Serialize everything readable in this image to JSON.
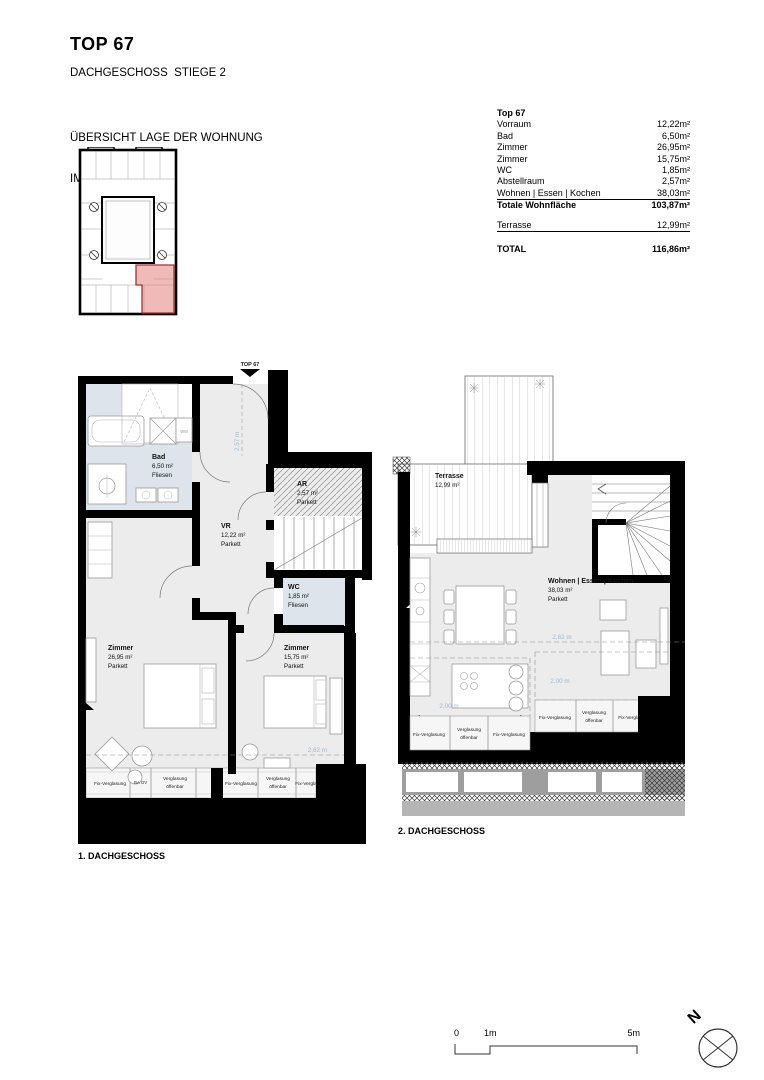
{
  "page": {
    "title": "TOP 67",
    "subtitle": "DACHGESCHOSS  STIEGE 2",
    "overview_heading_1": "ÜBERSICHT LAGE DER WOHNUNG",
    "overview_heading_2": "IM HAUS"
  },
  "area_table": {
    "title": "Top 67",
    "rows": [
      {
        "label": "Vorraum",
        "value": "12,22m²"
      },
      {
        "label": "Bad",
        "value": "6,50m²"
      },
      {
        "label": "Zimmer",
        "value": "26,95m²"
      },
      {
        "label": "Zimmer",
        "value": "15,75m²"
      },
      {
        "label": "WC",
        "value": "1,85m²"
      },
      {
        "label": "Abstellraum",
        "value": "2,57m²"
      },
      {
        "label": "Wohnen | Essen | Kochen",
        "value": "38,03m²"
      }
    ],
    "subtotal_label": "Totale Wohnfläche",
    "subtotal_value": "103,87m²",
    "terrace_label": "Terrasse",
    "terrace_value": "12,99m²",
    "total_label": "TOTAL",
    "total_value": "116,86m²"
  },
  "plan1": {
    "caption": "1. DACHGESCHOSS",
    "entrance_label": "TOP 67",
    "dim_entry": "2,57 m",
    "dim_width": "2,62 m",
    "wm_label": "WM",
    "ba_gv_label": "BA GV",
    "rooms": {
      "bad": {
        "name": "Bad",
        "area": "6,50 m²",
        "floor": "Fliesen"
      },
      "vr": {
        "name": "VR",
        "area": "12,22 m²",
        "floor": "Parkett"
      },
      "ar": {
        "name": "AR",
        "area": "2,57 m²",
        "floor": "Parkett"
      },
      "wc": {
        "name": "WC",
        "area": "1,85 m²",
        "floor": "Fliesen"
      },
      "zimmer_1": {
        "name": "Zimmer",
        "area": "26,95 m²",
        "floor": "Parkett"
      },
      "zimmer_2": {
        "name": "Zimmer",
        "area": "15,75 m²",
        "floor": "Parkett"
      }
    },
    "glazing": [
      {
        "l1": "Fix-Verglasung",
        "l2": ""
      },
      {
        "l1": "Verglasung",
        "l2": "öffenbar"
      },
      {
        "l1": "Fix-Verglasung",
        "l2": ""
      },
      {
        "l1": "Verglasung",
        "l2": "öffenbar"
      },
      {
        "l1": "Fix-Vergla",
        "l2": ""
      }
    ]
  },
  "plan2": {
    "caption": "2. DACHGESCHOSS",
    "dim_width": "2,62 m",
    "dim_left": "2,00 m",
    "dim_right": "2,00 m",
    "rooms": {
      "terrasse": {
        "name": "Terrasse",
        "area": "12,99 m²"
      },
      "wohnen": {
        "name": "Wohnen | Essen | Kochen",
        "area": "38,03 m²",
        "floor": "Parkett"
      }
    },
    "glazing_left": [
      {
        "l1": "Fix-Verglasung",
        "l2": ""
      },
      {
        "l1": "Verglasung",
        "l2": "öffenbar"
      },
      {
        "l1": "Fix-Verglasung",
        "l2": ""
      }
    ],
    "glazing_right": [
      {
        "l1": "Fix-Verglasung",
        "l2": ""
      },
      {
        "l1": "Verglasung",
        "l2": "öffenbar"
      },
      {
        "l1": "Fix-Vergla",
        "l2": ""
      }
    ]
  },
  "scale_bar": {
    "tick0": "0",
    "tick1": "1m",
    "tick5": "5m"
  },
  "compass": {
    "north_label": "N"
  },
  "colors": {
    "wall": "#000000",
    "room_fill": "#ececec",
    "wet_room_fill": "#dde4ec",
    "dimension_text": "#9db8cb",
    "unit_highlight": "#e4827e",
    "unit_highlight_stroke": "#a33330"
  }
}
